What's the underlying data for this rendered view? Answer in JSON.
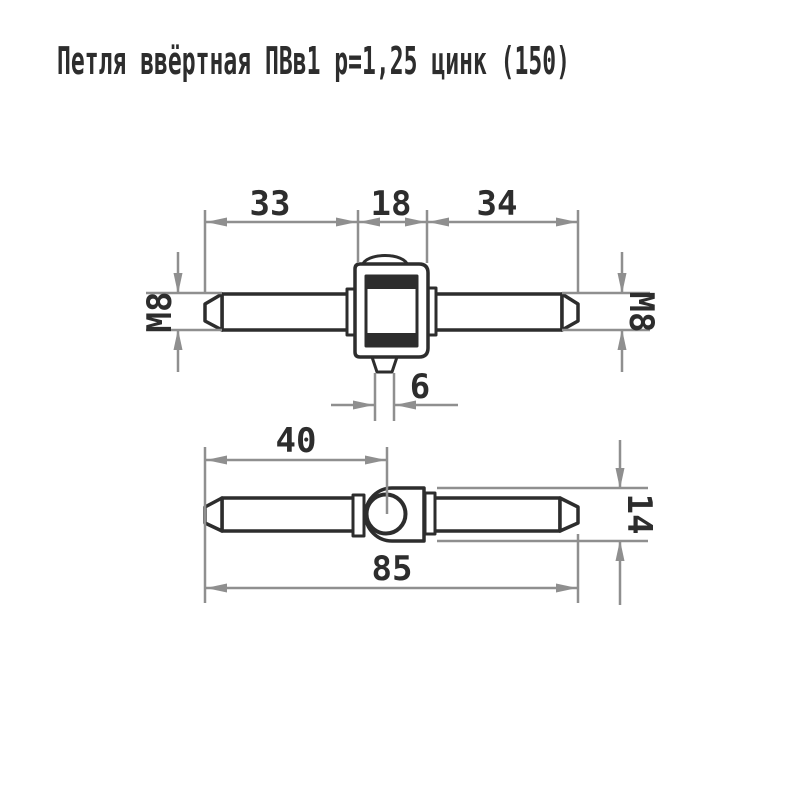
{
  "title": "Петля ввёртная ПВв1 p=1,25 цинк (150)",
  "colors": {
    "background": "#ffffff",
    "part_outline": "#2d2d2d",
    "dimension_lines": "#8f8f8f",
    "text": "#2d2d2d"
  },
  "views": {
    "top": {
      "dims": {
        "left_pin_length": "33",
        "knuckle_width": "18",
        "right_pin_length": "34",
        "thread_left": "М8",
        "thread_right": "М8",
        "tab_width": "6"
      }
    },
    "side": {
      "dims": {
        "to_center": "40",
        "overall_length": "85",
        "knuckle_height": "14"
      }
    }
  }
}
